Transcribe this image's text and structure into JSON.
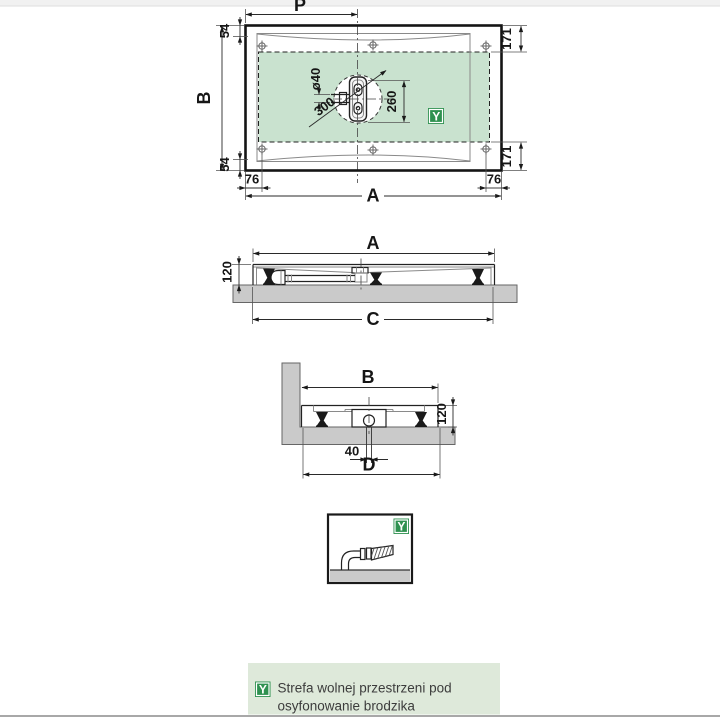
{
  "colors": {
    "free_zone": "#c9e2cf",
    "badge_green": "#2f9150",
    "legend_bg": "#dee9da",
    "concrete": "#cacaca"
  },
  "top_view": {
    "dim_drain_from_left": "P",
    "dim_depth": "B",
    "dim_width": "A",
    "rim_top": "54",
    "rim_bottom": "54",
    "zone_inset_top": "171",
    "zone_inset_bottom": "171",
    "corner_left": "76",
    "corner_right": "76",
    "drain_pipe": "ø40",
    "zone_height": "260",
    "zone_diagonal": "300",
    "zone_badge": "Y"
  },
  "front_view": {
    "dim_width": "A",
    "dim_height": "120",
    "dim_base": "C"
  },
  "side_view": {
    "dim_depth": "B",
    "dim_height": "120",
    "dim_pipe_offset": "40",
    "dim_base": "D"
  },
  "detail_view": {
    "zone_badge": "Y"
  },
  "legend": {
    "badge": "Y",
    "line1": "Strefa wolnej przestrzeni pod",
    "line2": "osyfonowanie brodzika"
  }
}
